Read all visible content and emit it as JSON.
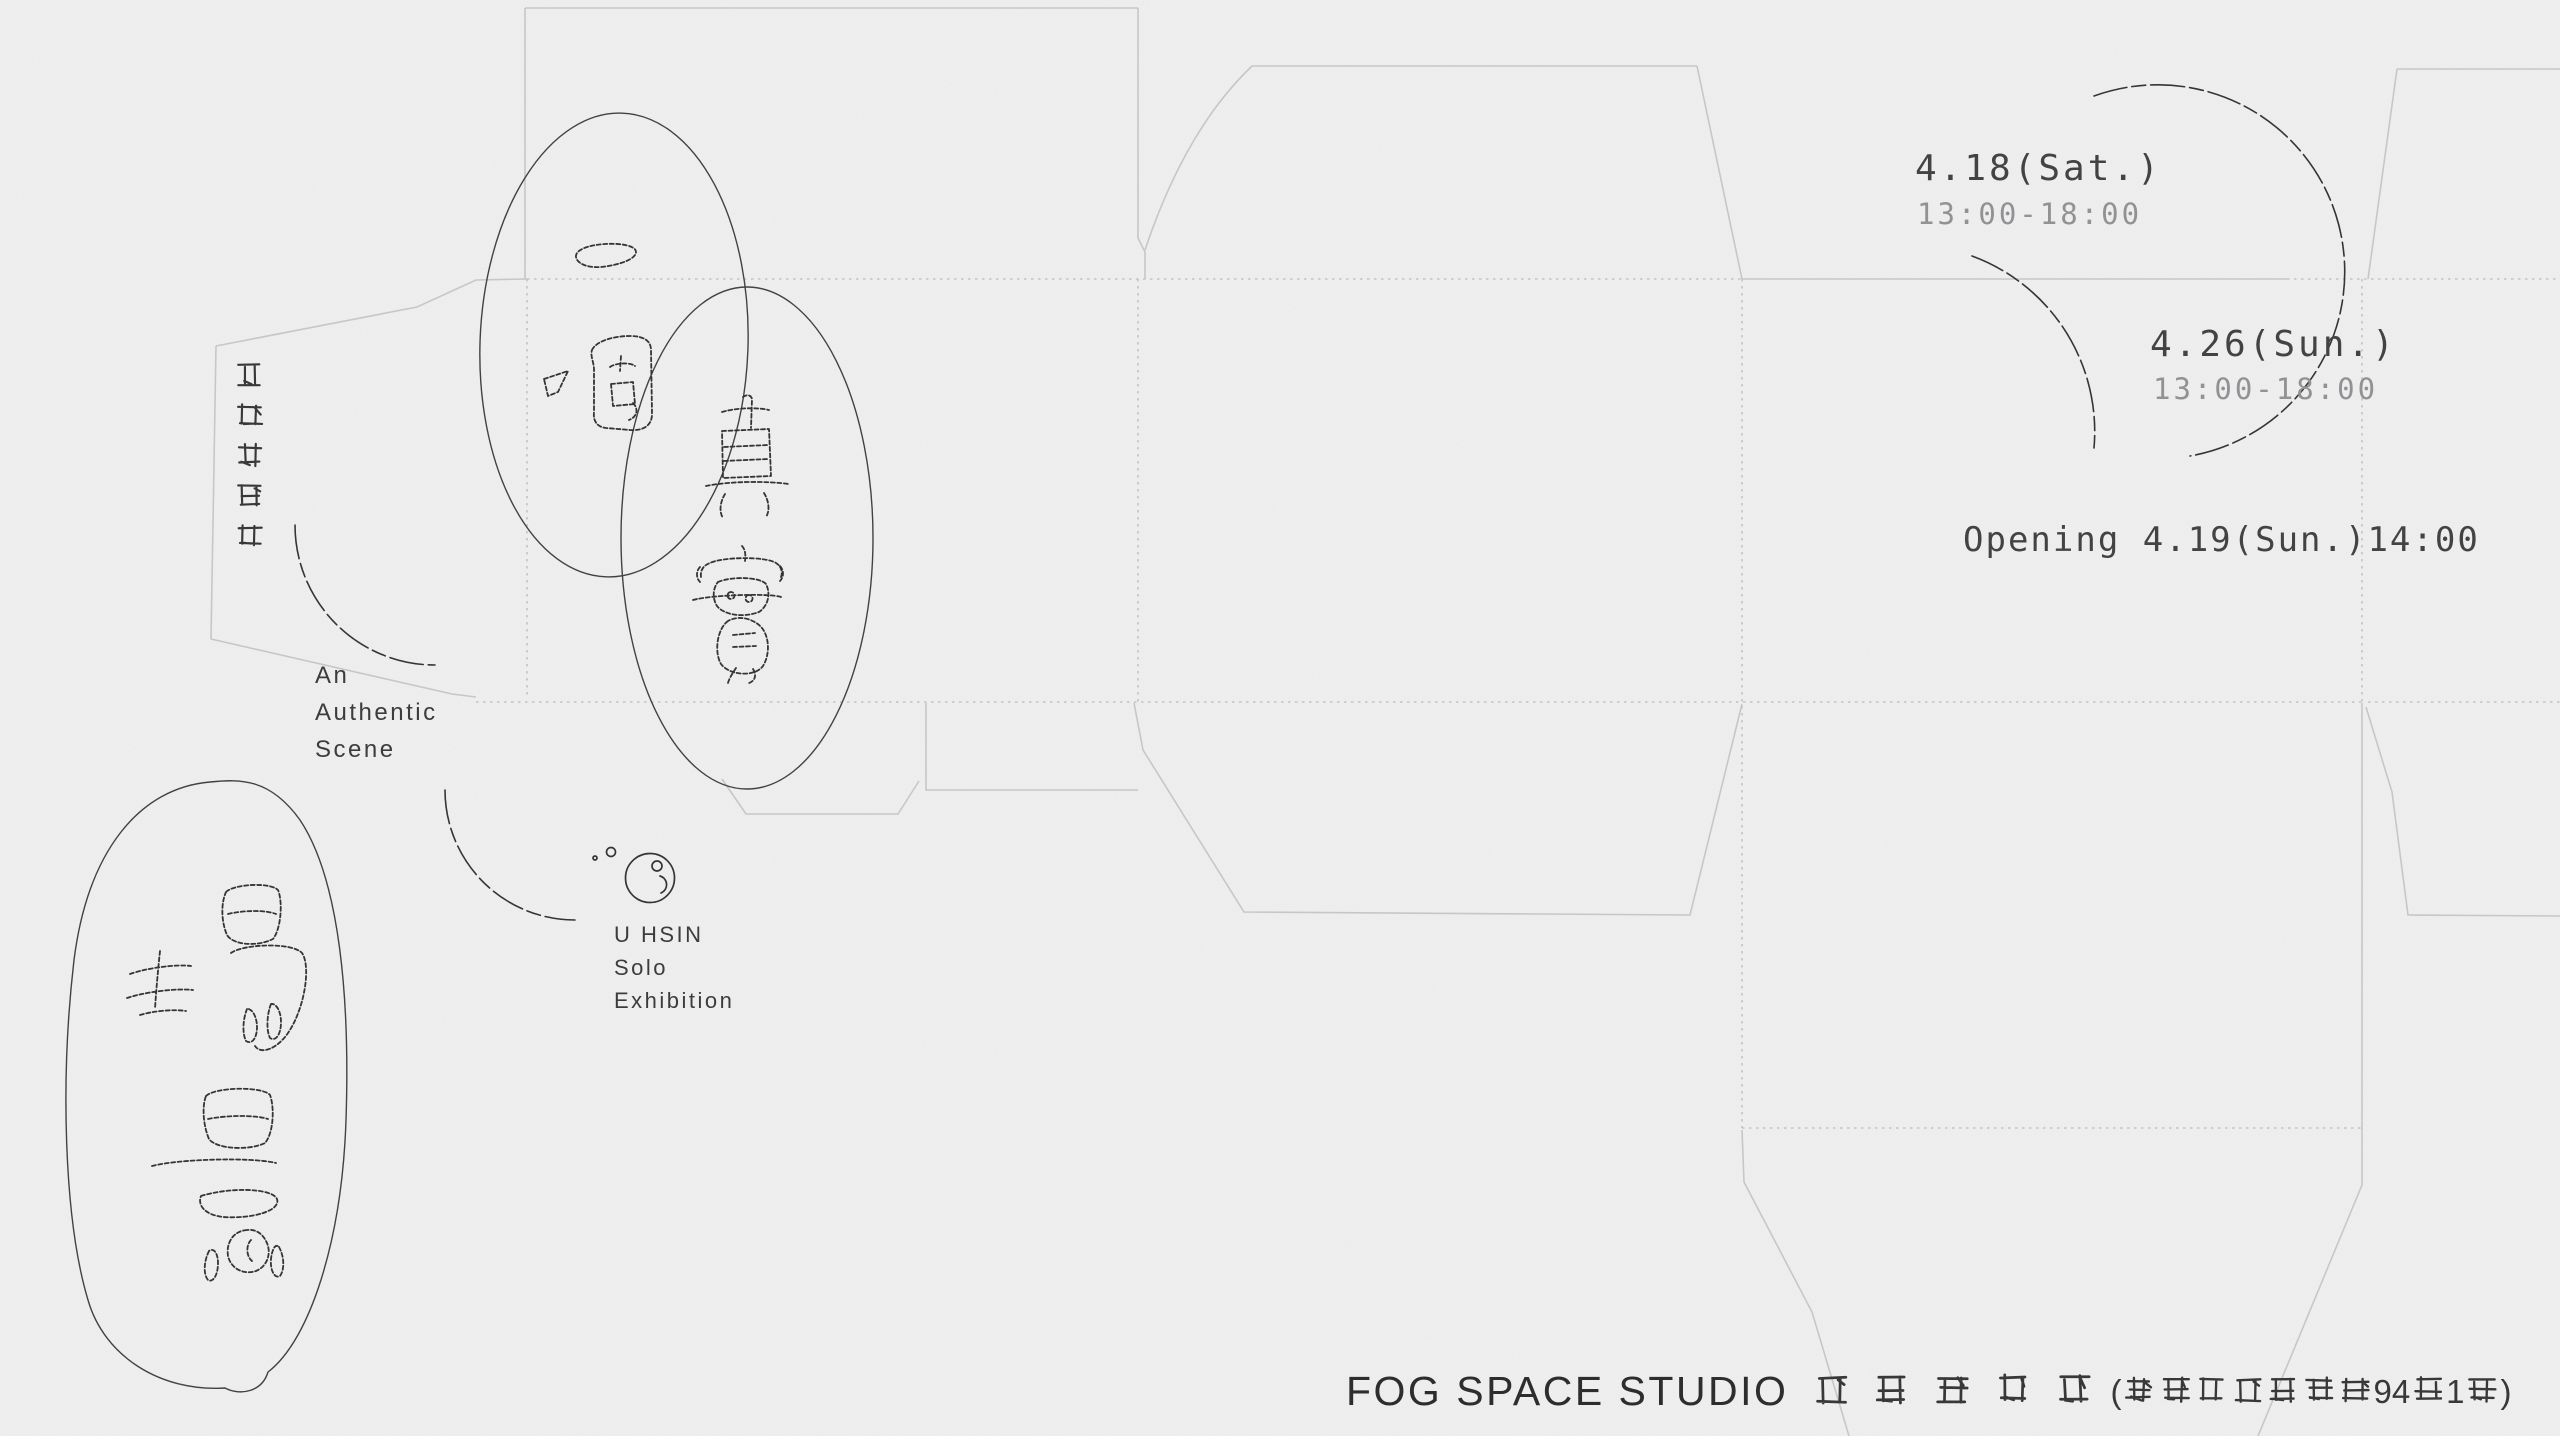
{
  "poster": {
    "artist_name_zh": "謝宇馨個展",
    "title_zh_sketch": {
      "ellipse1": "一個",
      "ellipse2": "真實",
      "ellipse3": "場景"
    },
    "title_en": {
      "line1": "An",
      "line2": "Authentic",
      "line3": "Scene"
    },
    "artist_en": {
      "line1": "U HSIN",
      "line2": "Solo",
      "line3": "Exhibition"
    },
    "schedule": {
      "date1": "4.18(Sat.)",
      "time1": "13:00-18:00",
      "date2": "4.26(Sun.)",
      "time2": "13:00-18:00",
      "opening": "Opening 4.19(Sun.)14:00"
    },
    "venue": {
      "name_latin": "FOG SPACE STUDIO",
      "name_zh": "士 林 霧 空 間",
      "address": "(台北市士林前街94號1樓)"
    },
    "colors": {
      "background": "#f0f0f1",
      "dieline": "#c7c7ca",
      "ink": "#2c2c2c",
      "muted": "#8f8f91"
    }
  }
}
